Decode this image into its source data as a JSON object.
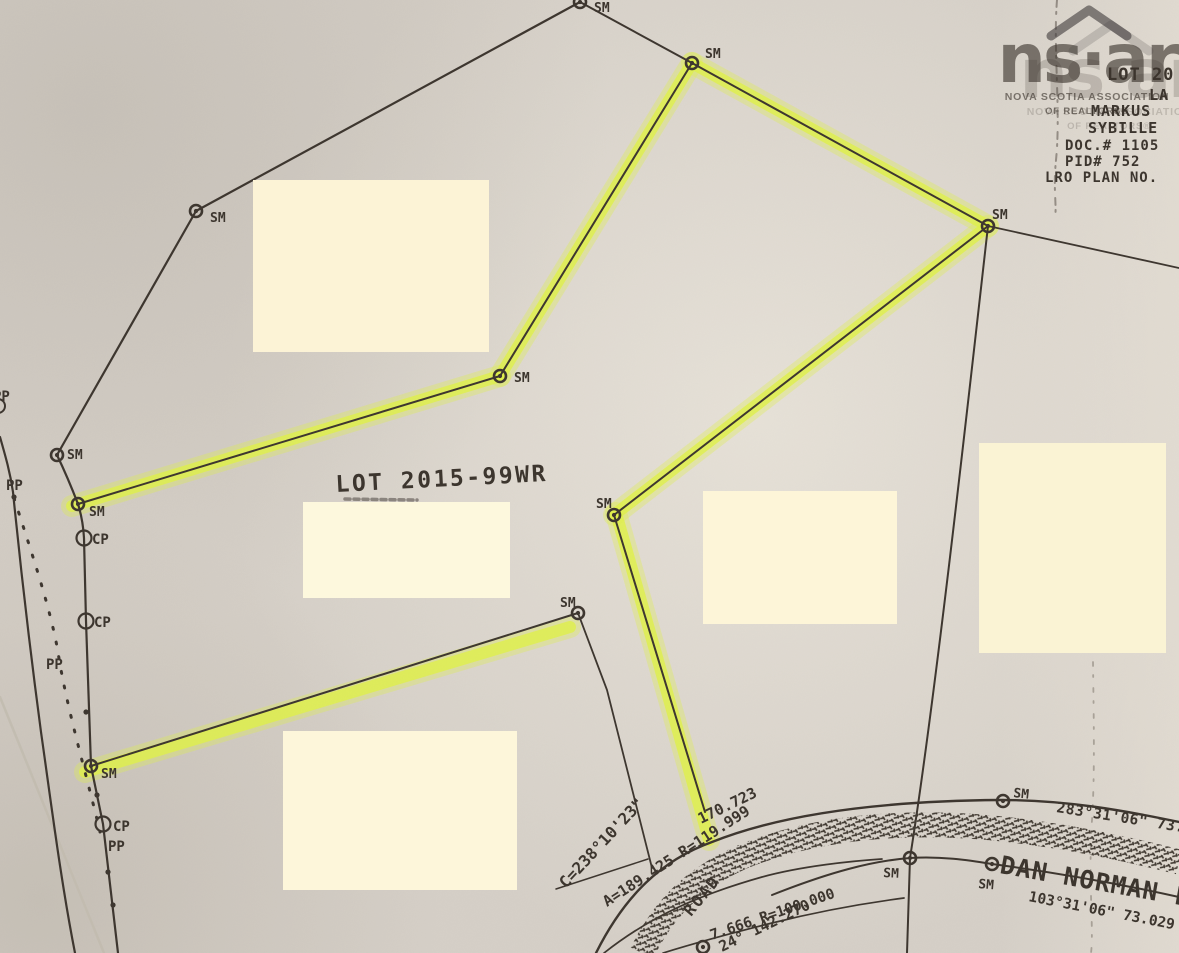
{
  "colors": {
    "paper": "#d6d0c8",
    "ink": "#3d362f",
    "highlight": "#e1f24b",
    "watermark": "#454040",
    "redaction_default": "#fcf3d6"
  },
  "watermark": {
    "brand": "ns·ar",
    "org_line1": "NOVA SCOTIA ASSOCIATION",
    "org_line2": "OF REALTORS®"
  },
  "plan": {
    "lot_label": "LOT 2015-99WR",
    "road_name": "DAN NORMAN LA",
    "redactions": [
      {
        "x": 253,
        "y": 180,
        "w": 236,
        "h": 172,
        "fill": "#fcf3d6"
      },
      {
        "x": 303,
        "y": 502,
        "w": 207,
        "h": 96,
        "fill": "#fdf8dd"
      },
      {
        "x": 283,
        "y": 731,
        "w": 234,
        "h": 159,
        "fill": "#fdf6da"
      },
      {
        "x": 703,
        "y": 491,
        "w": 194,
        "h": 133,
        "fill": "#fdf5d8"
      },
      {
        "x": 979,
        "y": 443,
        "w": 187,
        "h": 210,
        "fill": "#faf3d4"
      }
    ],
    "highlights": [
      [
        692,
        63,
        988,
        226
      ],
      [
        692,
        63,
        500,
        376
      ],
      [
        500,
        376,
        72,
        506
      ],
      [
        988,
        226,
        614,
        515
      ],
      [
        616,
        513,
        709,
        840
      ],
      [
        570,
        627,
        85,
        772
      ]
    ],
    "boundaries": [
      {
        "d": "M580,2 L196,211 L57,455 Q68,478 78,504 Q83,520 84,538 L86,621 L91,766 L103,824 L118,953",
        "w": 2.2
      },
      {
        "d": "M580,2 L692,63",
        "w": 2
      },
      {
        "d": "M692,63 L500,376 L78,504",
        "w": 2
      },
      {
        "d": "M692,63 L988,226",
        "w": 2
      },
      {
        "d": "M988,226 L1179,268",
        "w": 1.8
      },
      {
        "d": "M988,226 C965,430 935,700 910,858",
        "w": 2
      },
      {
        "d": "M988,226 L614,515 L705,812",
        "w": 2
      },
      {
        "d": "M578,613 L91,766",
        "w": 2
      },
      {
        "d": "M578,613 L607,690 L652,868",
        "w": 1.8
      },
      {
        "d": "M0,437 C6,458 10,472 13,492 C20,562 29,642 41,732 C51,802 61,882 75,953",
        "w": 2.2
      },
      {
        "d": "M556,889 L648,859",
        "w": 1.5
      },
      {
        "d": "M596,953 C625,895 662,860 712,842 C782,814 880,801 1000,800 C1065,800 1122,810 1179,822",
        "w": 2.4
      },
      {
        "d": "M772,895 C830,872 872,861 910,858 C940,856 968,860 992,864 C1052,872 1120,884 1179,897",
        "w": 2
      },
      {
        "d": "M910,858 L907,953",
        "w": 2
      },
      {
        "d": "M604,953 C652,915 702,894 762,877 C802,866 852,861 882,859",
        "w": 1.7
      },
      {
        "d": "M663,953 C692,944 732,933 772,923 C824,910 866,903 904,898",
        "w": 1.7
      },
      {
        "d": "M14,498 C30,548 50,606 58,652 C66,706 88,780 100,832",
        "w": 3,
        "dash": "2 13"
      }
    ],
    "road_band": {
      "d": "M642,953 C665,905 700,873 752,853 C822,827 902,821 982,827 C1052,833 1120,847 1179,862",
      "w": 25
    },
    "creases": [
      {
        "d": "M1057,0 C1053,50 1061,110 1056,160 C1053,190 1057,205 1055,218",
        "dash": "7 5 2 8",
        "w": 2,
        "color": "#6e675f",
        "op": 0.65
      },
      {
        "d": "M1094,558 C1090,640 1097,740 1092,820 C1088,880 1094,930 1091,953",
        "dash": "4 9 2 11",
        "w": 1.8,
        "color": "#756e64",
        "op": 0.5
      },
      {
        "d": "M0,697 L104,953",
        "w": 2.5,
        "color": "#c3bcb0",
        "op": 0.9
      },
      {
        "d": "M345,499 L417,500",
        "dash": "5 4",
        "w": 3.5,
        "color": "#4a443e",
        "op": 0.55
      }
    ],
    "markers": {
      "sm": [
        [
          580,
          2
        ],
        [
          692,
          63
        ],
        [
          196,
          211
        ],
        [
          988,
          226
        ],
        [
          500,
          376
        ],
        [
          57,
          455
        ],
        [
          78,
          504
        ],
        [
          614,
          515
        ],
        [
          578,
          613
        ],
        [
          91,
          766
        ],
        [
          1003,
          801
        ],
        [
          910,
          858
        ],
        [
          992,
          864
        ],
        [
          703,
          947
        ]
      ],
      "cp": [
        [
          84,
          538
        ],
        [
          86,
          621
        ],
        [
          103,
          824
        ]
      ],
      "partial": [
        [
          -2,
          406
        ]
      ],
      "dots": [
        [
          14,
          497
        ],
        [
          86,
          712
        ],
        [
          97,
          795
        ],
        [
          108,
          872
        ],
        [
          113,
          905
        ]
      ]
    },
    "labels": [
      {
        "t": "SM",
        "x": 594,
        "y": 12,
        "s": 13
      },
      {
        "t": "SM",
        "x": 705,
        "y": 58,
        "s": 13
      },
      {
        "t": "SM",
        "x": 210,
        "y": 222,
        "s": 13
      },
      {
        "t": "SM",
        "x": 992,
        "y": 219,
        "s": 13
      },
      {
        "t": "SM",
        "x": 514,
        "y": 382,
        "s": 13
      },
      {
        "t": "SM",
        "x": 67,
        "y": 459,
        "s": 13
      },
      {
        "t": "SM",
        "x": 89,
        "y": 516,
        "s": 13
      },
      {
        "t": "SM",
        "x": 596,
        "y": 508,
        "s": 13
      },
      {
        "t": "SM",
        "x": 560,
        "y": 607,
        "s": 13
      },
      {
        "t": "SM",
        "x": 101,
        "y": 778,
        "s": 13
      },
      {
        "t": "SM",
        "x": 1013,
        "y": 797,
        "s": 13,
        "rot": 6
      },
      {
        "t": "SM",
        "x": 883,
        "y": 877,
        "s": 13,
        "rot": 3
      },
      {
        "t": "SM",
        "x": 978,
        "y": 888,
        "s": 13,
        "rot": 5
      },
      {
        "t": "PP",
        "x": 6,
        "y": 490,
        "s": 14
      },
      {
        "t": "PP",
        "x": 46,
        "y": 669,
        "s": 14
      },
      {
        "t": "PP",
        "x": 108,
        "y": 851,
        "s": 14
      },
      {
        "t": "PP",
        "x": -7,
        "y": 401,
        "s": 14
      },
      {
        "t": "CP",
        "x": 92,
        "y": 544,
        "s": 14
      },
      {
        "t": "CP",
        "x": 94,
        "y": 627,
        "s": 14
      },
      {
        "t": "CP",
        "x": 113,
        "y": 831,
        "s": 14
      },
      {
        "t": "LOT 2015-99WR",
        "x": 336,
        "y": 492,
        "s": 23,
        "rot": -3,
        "ls": 2.5
      },
      {
        "t": "C=238°10'23\"",
        "x": 566,
        "y": 889,
        "s": 16,
        "rot": -47
      },
      {
        "t": "A=189.425 R=119.999",
        "x": 607,
        "y": 907,
        "s": 15,
        "rot": -33
      },
      {
        "t": "170.723",
        "x": 701,
        "y": 824,
        "s": 15,
        "rot": -26
      },
      {
        "t": "ROAD",
        "x": 691,
        "y": 917,
        "s": 16,
        "rot": -50,
        "ls": 2
      },
      {
        "t": "7.666 R=100.000",
        "x": 712,
        "y": 940,
        "s": 14.5,
        "rot": -19
      },
      {
        "t": "24° 142.270",
        "x": 722,
        "y": 952,
        "s": 15,
        "rot": -26
      },
      {
        "t": "283°31'06\" 73.6",
        "x": 1056,
        "y": 812,
        "s": 14.5,
        "rot": 9,
        "ls": 0.5
      },
      {
        "t": "DAN NORMAN LA",
        "x": 999,
        "y": 873,
        "s": 25,
        "rot": 10,
        "ls": 1
      },
      {
        "t": "103°31'06\" 73.029",
        "x": 1028,
        "y": 901,
        "s": 14.5,
        "rot": 11
      },
      {
        "t": "LOT 20",
        "x": 1107,
        "y": 80,
        "s": 17,
        "ls": 1
      },
      {
        "t": "LA",
        "x": 1149,
        "y": 100,
        "s": 15,
        "ls": 1
      },
      {
        "t": "MARKUS",
        "x": 1091,
        "y": 116,
        "s": 15,
        "ls": 1
      },
      {
        "t": "SYBILLE",
        "x": 1088,
        "y": 133,
        "s": 15,
        "ls": 1
      },
      {
        "t": "DOC.# 1105",
        "x": 1065,
        "y": 150,
        "s": 14,
        "ls": 1
      },
      {
        "t": "PID# 752",
        "x": 1065,
        "y": 166,
        "s": 14,
        "ls": 1
      },
      {
        "t": "LRO PLAN NO.",
        "x": 1045,
        "y": 182,
        "s": 14,
        "ls": 1
      }
    ]
  }
}
